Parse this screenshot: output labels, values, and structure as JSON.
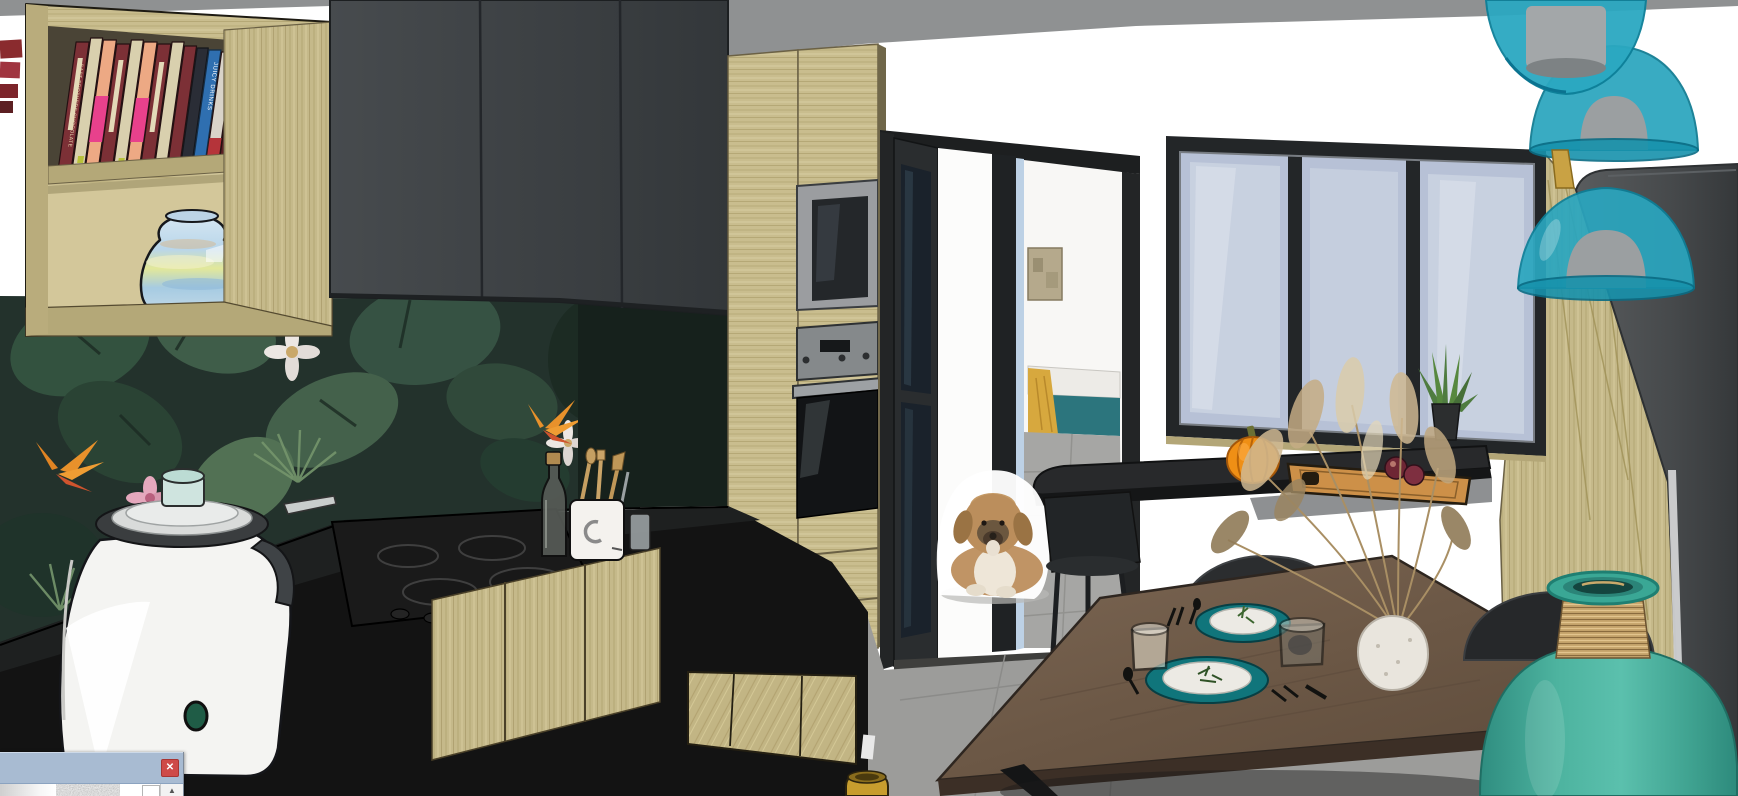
{
  "palette": {
    "ceiling": "#8f9192",
    "wall": "#ffffff",
    "cabinet_dark": "#3a3e41",
    "wood": "#c9bd8e",
    "counter_black": "#141414",
    "backsplash_green": "#23322c",
    "glass_blue": "#b7c1d6",
    "frame_black": "#232628",
    "floor_gray": "#9c9c9a",
    "bed_teal": "#2c757d",
    "throw_mustard": "#d7a83e",
    "pumpkin_orange": "#ef8f15",
    "lamp_teal": "#29a4bd",
    "vase_teal": "#4db39f",
    "plate_teal": "#10757b",
    "table_wood": "#6f5b49",
    "dog_tan": "#bb8e5c",
    "titlebar_blue": "#a8bbd2",
    "close_red": "#ce4a48"
  },
  "dialog": {
    "close_icon": "✕",
    "scroll_up_icon": "▲"
  },
  "bookshelf": {
    "spine_titles": [
      "EAST BROTHERS CHOCOLATE",
      "JUICY DRINKS"
    ]
  }
}
